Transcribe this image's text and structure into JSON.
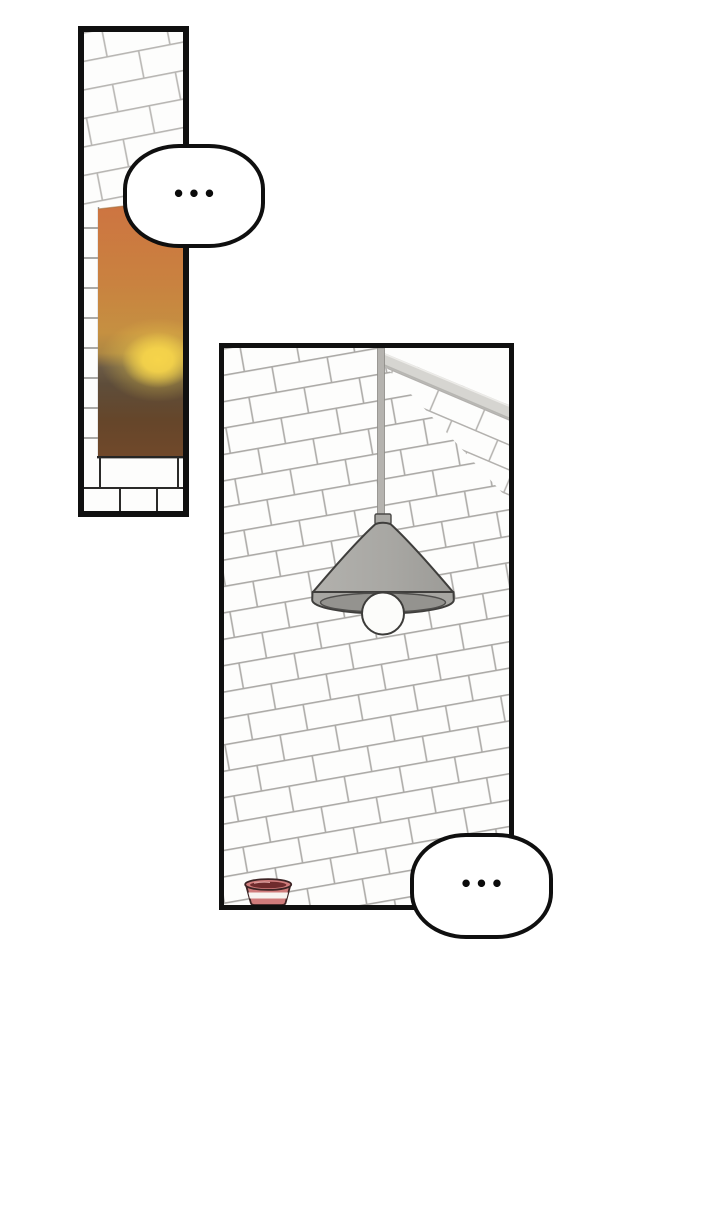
{
  "page": {
    "kind": "webtoon comic page",
    "background_color": "#ffffff",
    "ink_color": "#101010"
  },
  "bubbles": [
    {
      "text": "•••"
    },
    {
      "text": "•••"
    }
  ],
  "panels": [
    {
      "id": "sunset-window",
      "objects": [
        "white-brick-wall",
        "window-reveal",
        "sunset-sky",
        "sun-glow",
        "brick-window-sill"
      ],
      "colors": {
        "sunset_top": "#cd7541",
        "sunset_upper_mid": "#c98240",
        "sunset_mid": "#c59041",
        "dusk_ground": "#5e4d3a",
        "sunset_bottom": "#70482a",
        "sun_glow": "#f6d44a"
      }
    },
    {
      "id": "lamp-brick-wall",
      "objects": [
        "white-brick-wall",
        "ceiling-beam",
        "pendant-lamp",
        "lamp-cord",
        "light-bulb",
        "striped-cup"
      ],
      "colors": {
        "beam_gray": "#d6d5d1",
        "lamp_shade_gray": "#a7a6a2",
        "lamp_opening_gray": "#94938f",
        "bulb_white": "#fcfcfa",
        "cup_red": "#d07c7c",
        "cup_rim_dark": "#6f2b2d",
        "cup_stripe_white": "#f7f3f0"
      }
    }
  ]
}
